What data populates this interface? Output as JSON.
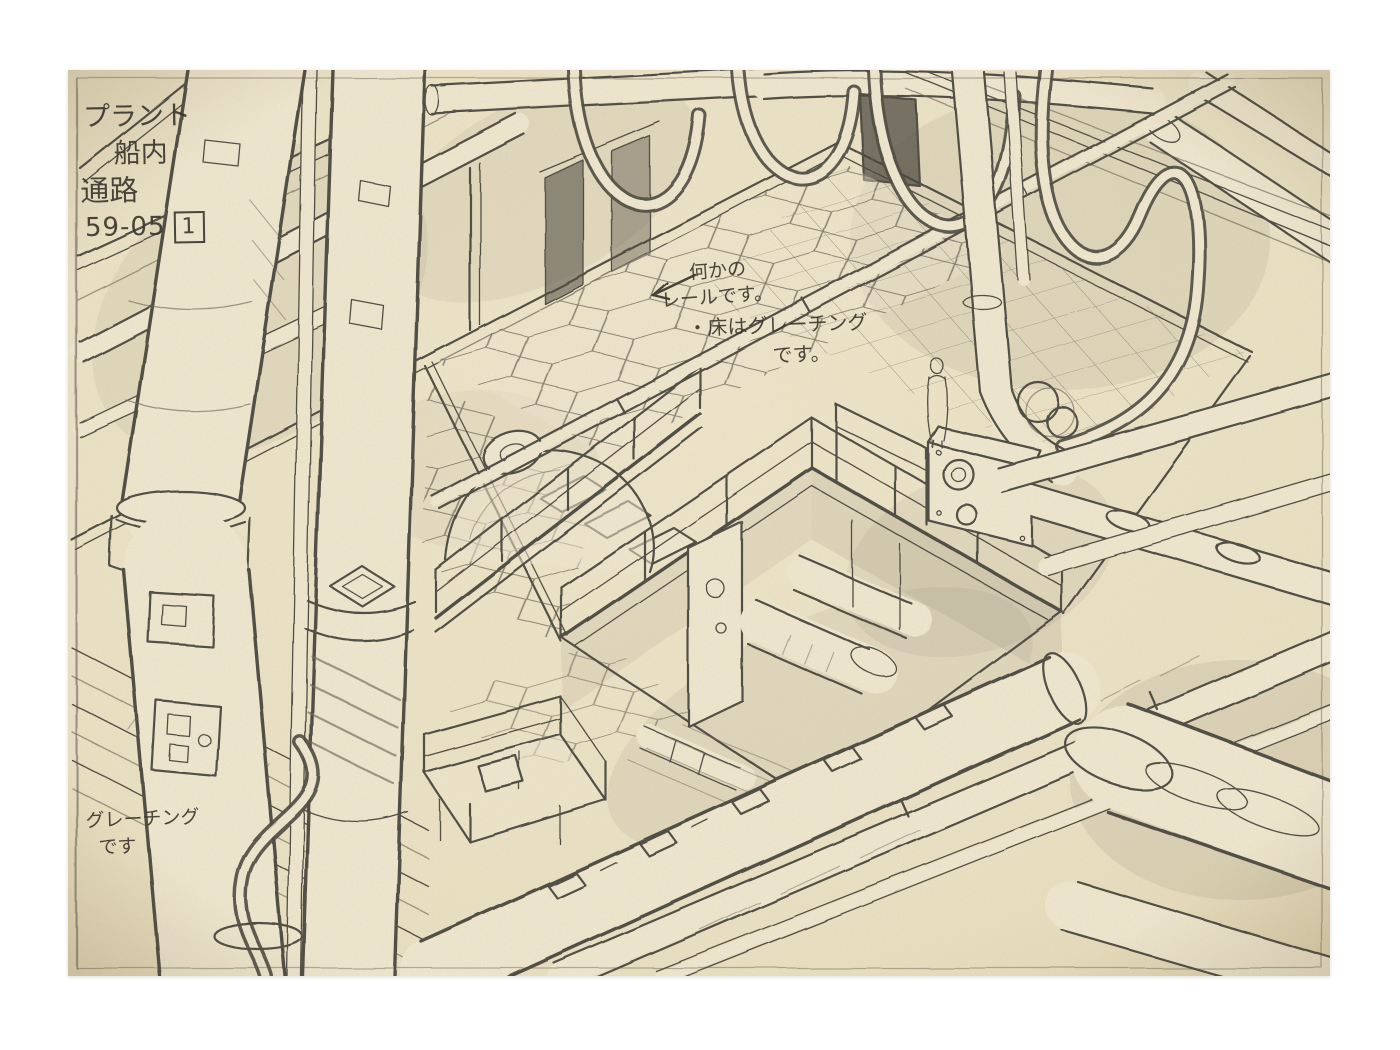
{
  "artwork": {
    "background_color": "#ffffff",
    "paper_color": "#ece2c5",
    "pencil_color": "#4e4b42",
    "text_color": "#3a372e"
  },
  "corner_label": {
    "line1": "プラント",
    "line2": "船内",
    "line3": "通路",
    "cut_code": "59-05",
    "cut_number": "1"
  },
  "notes": {
    "rail_line1": "何かの",
    "rail_line2": "レールです。",
    "floor_line1": "・床はグレーチング",
    "floor_line2": "です。",
    "grating_line1": "グレーチング",
    "grating_line2": "です"
  }
}
